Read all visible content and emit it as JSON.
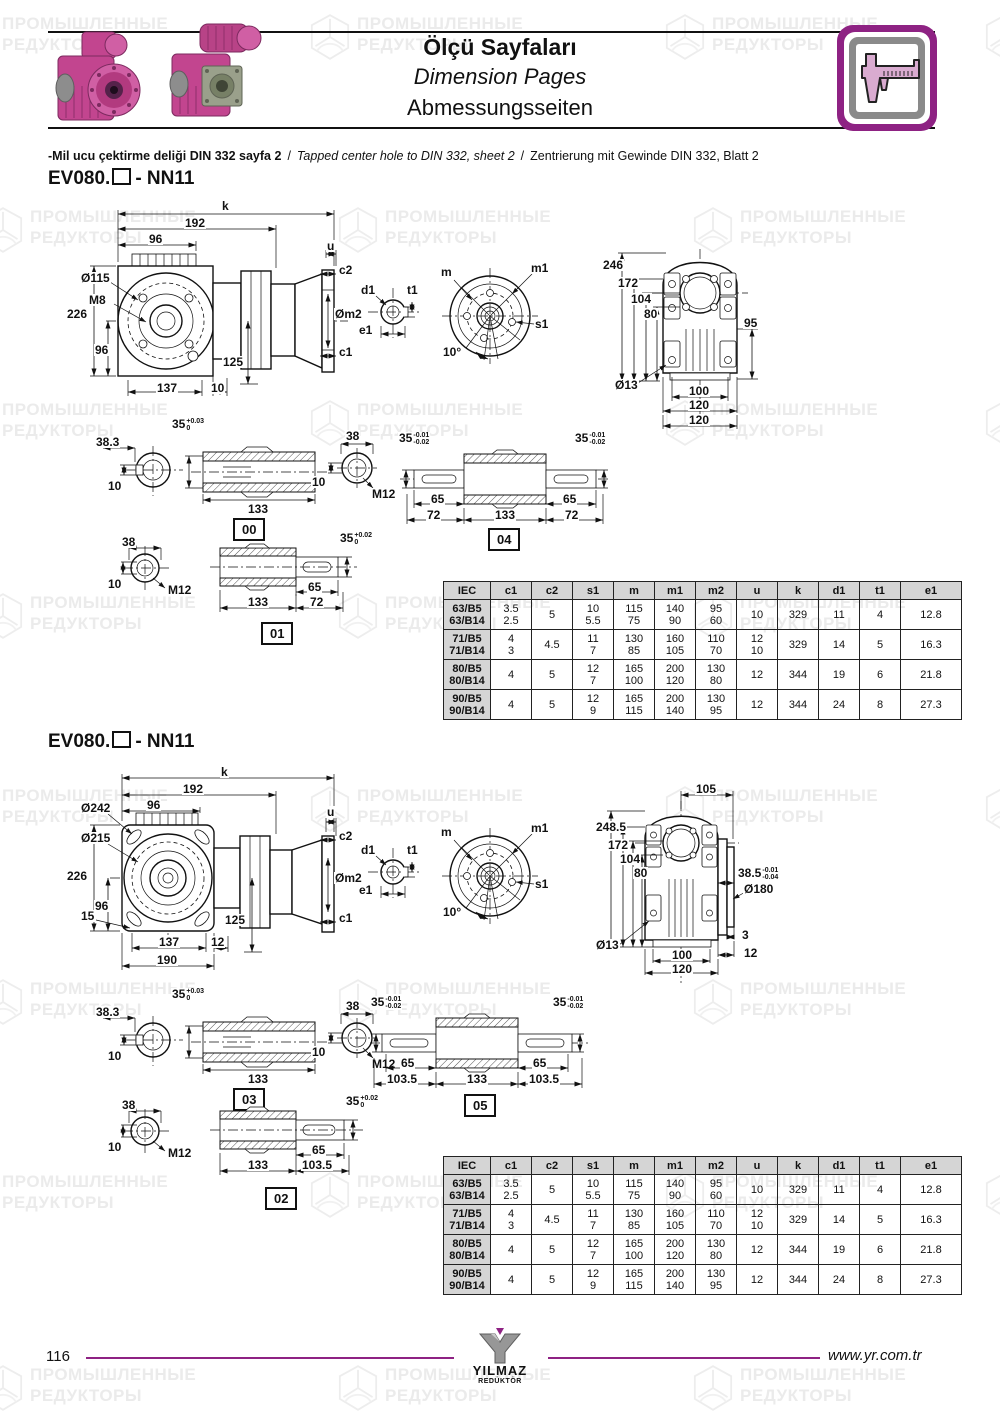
{
  "colors": {
    "accent": "#8e2283",
    "table_header_bg": "#d5d5d5"
  },
  "watermark": {
    "line1": "ПРОМЫШЛЕННЫЕ",
    "line2": "РЕДУКТОРЫ"
  },
  "header": {
    "title_tr": "Ölçü Sayfaları",
    "title_en": "Dimension Pages",
    "title_de": "Abmessungsseiten"
  },
  "note": {
    "tr": "-Mil ucu çektirme deliği DIN 332 sayfa 2",
    "sep": "/",
    "en": "Tapped center hole to DIN 332, sheet 2",
    "de": "Zentrierung mit Gewinde DIN 332, Blatt 2"
  },
  "s1": {
    "heading_prefix": "EV080.",
    "heading_suffix": "- NN11",
    "side": {
      "k": "k",
      "l192": "192",
      "l96t": "96",
      "dia115": "Ø115",
      "m8": "M8",
      "l226": "226",
      "l96": "96",
      "l137": "137",
      "l10": "10",
      "l125": "125",
      "u": "u",
      "c2": "c2",
      "om2": "Øm2",
      "c1": "c1"
    },
    "detail": {
      "d1": "d1",
      "t1": "t1",
      "e1": "e1"
    },
    "flange": {
      "m": "m",
      "m1": "m1",
      "s1": "s1",
      "ang": "10°"
    },
    "rear": {
      "l246": "246",
      "l172": "172",
      "l104": "104",
      "l80": "80",
      "l95": "95",
      "dia13": "Ø13",
      "l100": "100",
      "l120a": "120",
      "l120b": "120"
    },
    "sh00": {
      "l383": "38.3",
      "l10a": "10",
      "l35": "35",
      "tolh": "+0.03",
      "toll": "0",
      "l133": "133",
      "l38": "38",
      "l10b": "10",
      "m12": "M12",
      "tag": "00"
    },
    "sh04": {
      "l35": "35",
      "tolh": "-0.01",
      "toll": "-0.02",
      "l65a": "65",
      "l72a": "72",
      "l133": "133",
      "l72b": "72",
      "l65b": "65",
      "tag": "04"
    },
    "sh01": {
      "l38": "38",
      "l10": "10",
      "m12": "M12",
      "l35": "35",
      "tolh": "+0.02",
      "toll": "0",
      "l133": "133",
      "l65": "65",
      "l72": "72",
      "tag": "01"
    }
  },
  "s2": {
    "heading_prefix": "EV080.",
    "heading_suffix": "- NN11",
    "side": {
      "k": "k",
      "l192": "192",
      "l96t": "96",
      "dia242": "Ø242",
      "dia215": "Ø215",
      "l226": "226",
      "l96": "96",
      "l15": "15",
      "l137": "137",
      "l12": "12",
      "l190": "190",
      "l125": "125",
      "u": "u",
      "c2": "c2",
      "om2": "Øm2",
      "c1": "c1"
    },
    "detail": {
      "d1": "d1",
      "t1": "t1",
      "e1": "e1"
    },
    "flange": {
      "m": "m",
      "m1": "m1",
      "s1": "s1",
      "ang": "10°"
    },
    "rear": {
      "l105": "105",
      "l2485": "248.5",
      "l172": "172",
      "l104": "104",
      "l80": "80",
      "l385": "38.5",
      "tolh": "-0.01",
      "toll": "-0.04",
      "dia180": "Ø180",
      "dia13": "Ø13",
      "l100": "100",
      "l120": "120",
      "l3": "3",
      "l12": "12"
    },
    "sh03": {
      "l383": "38.3",
      "l10a": "10",
      "l35": "35",
      "tolh": "+0.03",
      "toll": "0",
      "l133": "133",
      "l38": "38",
      "l10b": "10",
      "m12": "M12",
      "tag": "03"
    },
    "sh05": {
      "l35": "35",
      "tolh": "-0.01",
      "toll": "-0.02",
      "l65a": "65",
      "l1035a": "103.5",
      "l133": "133",
      "l1035b": "103.5",
      "l65b": "65",
      "tag": "05"
    },
    "sh02": {
      "l38": "38",
      "l10": "10",
      "m12": "M12",
      "l35": "35",
      "tolh": "+0.02",
      "toll": "0",
      "l133": "133",
      "l65": "65",
      "l1035": "103.5",
      "tag": "02"
    }
  },
  "table": {
    "headers": [
      "IEC",
      "c1",
      "c2",
      "s1",
      "m",
      "m1",
      "m2",
      "u",
      "k",
      "d1",
      "t1",
      "e1"
    ],
    "widths": [
      46,
      40,
      40,
      40,
      40,
      40,
      40,
      40,
      40,
      40,
      40,
      60
    ],
    "rows": [
      [
        [
          "63/B5",
          "63/B14"
        ],
        [
          "3.5",
          "2.5"
        ],
        [
          "5"
        ],
        [
          "10",
          "5.5"
        ],
        [
          "115",
          "75"
        ],
        [
          "140",
          "90"
        ],
        [
          "95",
          "60"
        ],
        [
          "10"
        ],
        [
          "329"
        ],
        [
          "11"
        ],
        [
          "4"
        ],
        [
          "12.8"
        ]
      ],
      [
        [
          "71/B5",
          "71/B14"
        ],
        [
          "4",
          "3"
        ],
        [
          "4.5"
        ],
        [
          "11",
          "7"
        ],
        [
          "130",
          "85"
        ],
        [
          "160",
          "105"
        ],
        [
          "110",
          "70"
        ],
        [
          "12",
          "10"
        ],
        [
          "329"
        ],
        [
          "14"
        ],
        [
          "5"
        ],
        [
          "16.3"
        ]
      ],
      [
        [
          "80/B5",
          "80/B14"
        ],
        [
          "4"
        ],
        [
          "5"
        ],
        [
          "12",
          "7"
        ],
        [
          "165",
          "100"
        ],
        [
          "200",
          "120"
        ],
        [
          "130",
          "80"
        ],
        [
          "12"
        ],
        [
          "344"
        ],
        [
          "19"
        ],
        [
          "6"
        ],
        [
          "21.8"
        ]
      ],
      [
        [
          "90/B5",
          "90/B14"
        ],
        [
          "4"
        ],
        [
          "5"
        ],
        [
          "12",
          "9"
        ],
        [
          "165",
          "115"
        ],
        [
          "200",
          "140"
        ],
        [
          "130",
          "95"
        ],
        [
          "12"
        ],
        [
          "344"
        ],
        [
          "24"
        ],
        [
          "8"
        ],
        [
          "27.3"
        ]
      ]
    ]
  },
  "footer": {
    "page": "116",
    "url": "www.yr.com.tr",
    "logo_name": "YILMAZ",
    "logo_sub": "REDÜKTÖR"
  }
}
